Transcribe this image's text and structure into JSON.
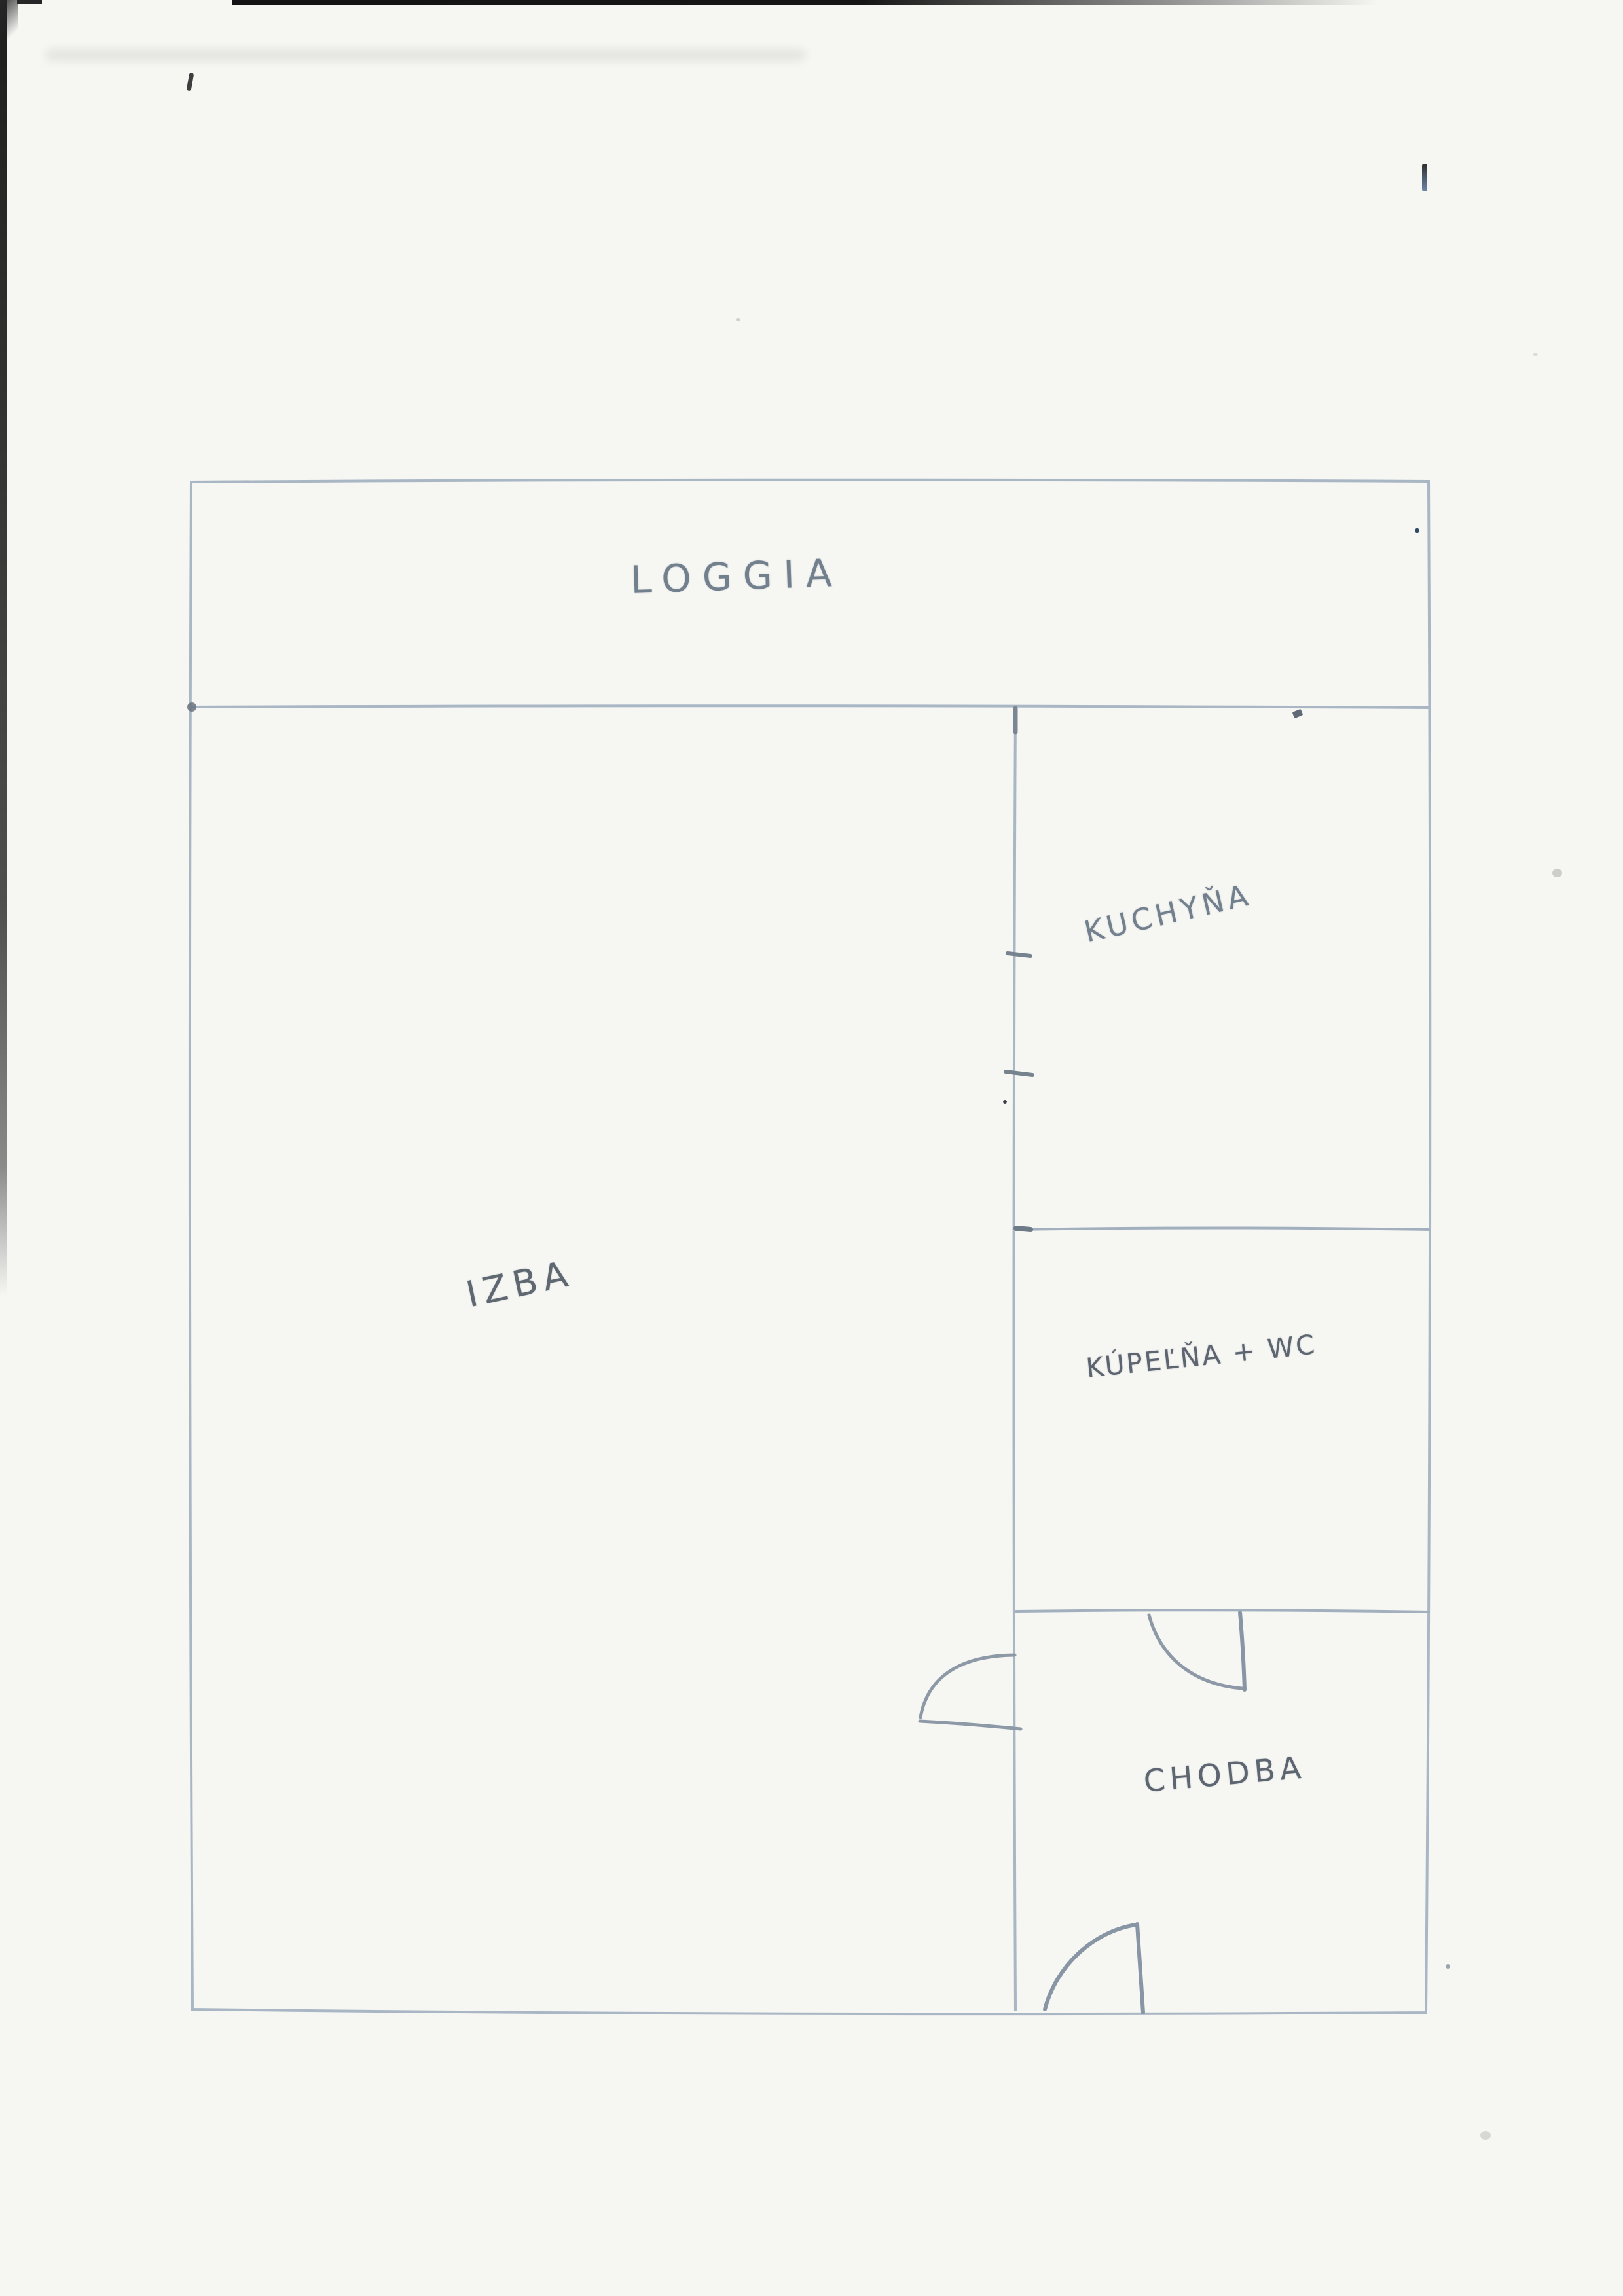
{
  "floor_plan": {
    "rooms": {
      "loggia": {
        "label": "LOGGIA"
      },
      "izba": {
        "label": "IZBA"
      },
      "kuchyna": {
        "label": "KUCHYŇA"
      },
      "kupelna_wc": {
        "label": "KÚPEĽŇA + WC"
      },
      "chodba": {
        "label": "CHODBA"
      }
    },
    "doors": [
      {
        "name": "izba-door"
      },
      {
        "name": "kupelna-chodba-door"
      },
      {
        "name": "entrance-door"
      }
    ],
    "colors": {
      "paper": "#f6f6f3",
      "wall_line": "#a9b6c4",
      "door_line": "#8d99a6",
      "pencil_text": "#6f7a85",
      "scan_edge": "#1f1f1f"
    }
  }
}
